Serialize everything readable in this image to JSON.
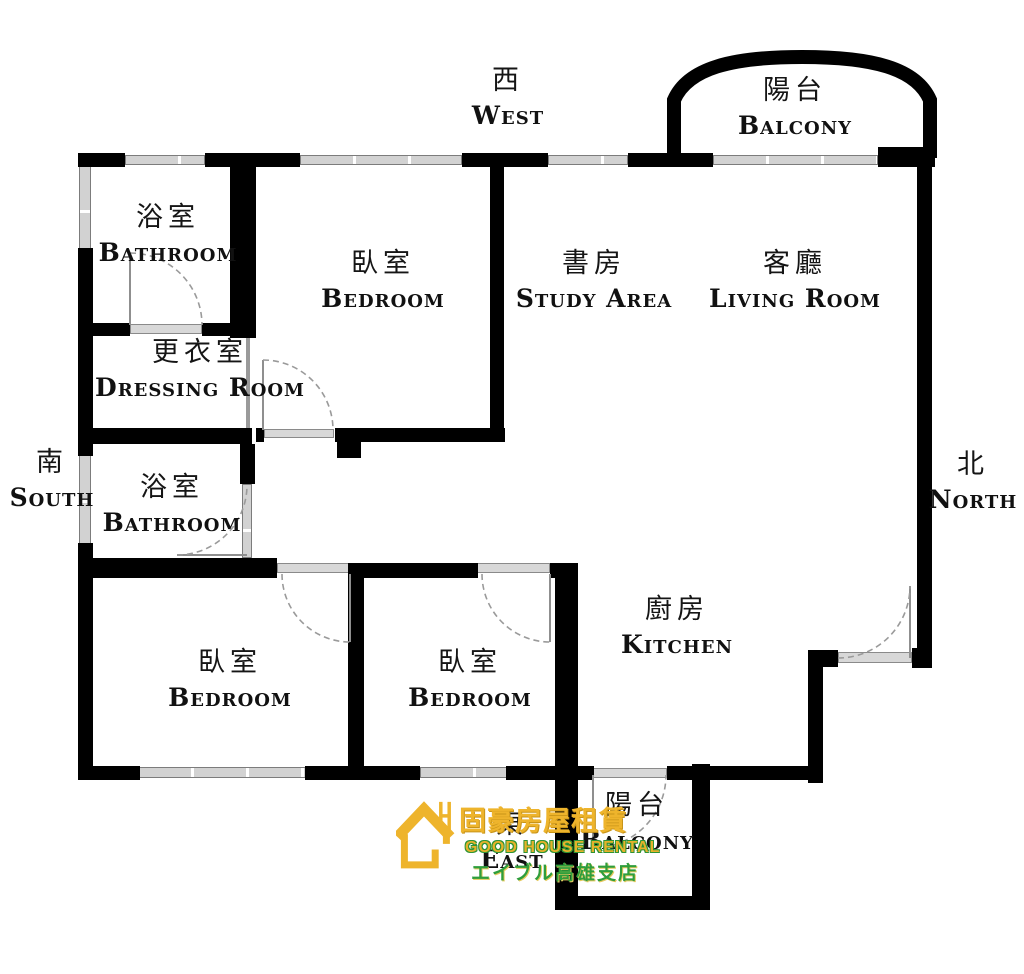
{
  "title": "Apartment floor plan",
  "compass": {
    "west": {
      "zh": "西",
      "en": "West"
    },
    "south": {
      "zh": "南",
      "en": "South"
    },
    "north": {
      "zh": "北",
      "en": "North"
    },
    "east": {
      "zh": "東",
      "en": "East"
    }
  },
  "rooms": {
    "bathroom_nw": {
      "zh": "浴室",
      "en": "Bathroom"
    },
    "bedroom_w": {
      "zh": "臥室",
      "en": "Bedroom"
    },
    "study_area": {
      "zh": "書房",
      "en": "Study Area"
    },
    "living_room": {
      "zh": "客廳",
      "en": "Living Room"
    },
    "dressing_room": {
      "zh": "更衣室",
      "en": "Dressing Room"
    },
    "bathroom_w": {
      "zh": "浴室",
      "en": "Bathroom"
    },
    "bedroom_sw": {
      "zh": "臥室",
      "en": "Bedroom"
    },
    "bedroom_s": {
      "zh": "臥室",
      "en": "Bedroom"
    },
    "kitchen": {
      "zh": "廚房",
      "en": "Kitchen"
    },
    "balcony_n": {
      "zh": "陽台",
      "en": "Balcony"
    },
    "balcony_s": {
      "zh": "陽台",
      "en": "Balcony"
    }
  },
  "logo": {
    "company_zh": "固豪房屋租賃",
    "company_en": "GOOD HOUSE RENTAL",
    "branch_ja": "エイブル高雄支店"
  },
  "colors": {
    "wall": "#000000",
    "window": "#d6d6d6",
    "door_arc": "#999999",
    "logo_gold": "#eeb42c",
    "logo_green": "#2f9e3c"
  }
}
